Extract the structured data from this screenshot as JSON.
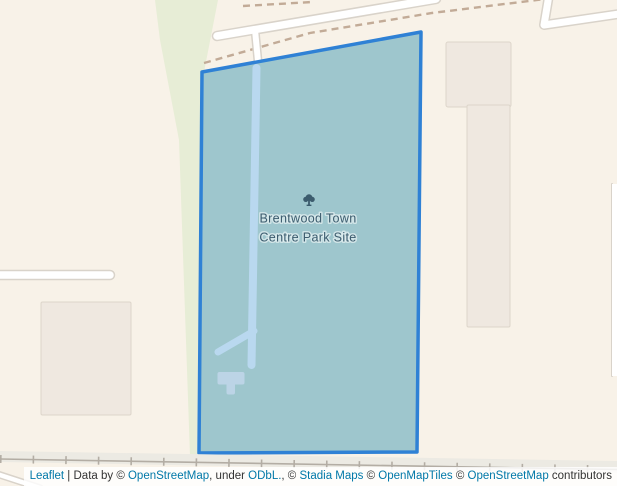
{
  "park_label": {
    "line1": "Brentwood Town",
    "line2": "Centre Park Site"
  },
  "attribution": {
    "parts": [
      {
        "text": "Leaflet"
      },
      {
        "text": " | Data by © "
      },
      {
        "text": "OpenStreetMap"
      },
      {
        "text": ", under "
      },
      {
        "text": "ODbL."
      },
      {
        "text": ", © "
      },
      {
        "text": "Stadia Maps"
      },
      {
        "text": " © "
      },
      {
        "text": "OpenMapTiles"
      },
      {
        "text": " © "
      },
      {
        "text": "OpenStreetMap"
      },
      {
        "text": " contributors"
      }
    ]
  },
  "colors": {
    "land": "#f8f2e8",
    "green_area": "#e7edd6",
    "building_fill": "#efe8e0",
    "building_stroke": "#ddd5ca",
    "road_fill": "#ffffff",
    "road_casing": "#d9d3ca",
    "path_dash": "#c2ab97",
    "railway_band": "#eceae3",
    "railway_line": "#b3ada4",
    "polygon_fill": "#9ec6cd",
    "polygon_stroke": "#2f81d5",
    "inner_path": "#b9d8ef",
    "inner_building": "#bcd4e6",
    "label_text": "#3c5c6e",
    "link": "#0078a8",
    "attribution_text": "#333333"
  }
}
